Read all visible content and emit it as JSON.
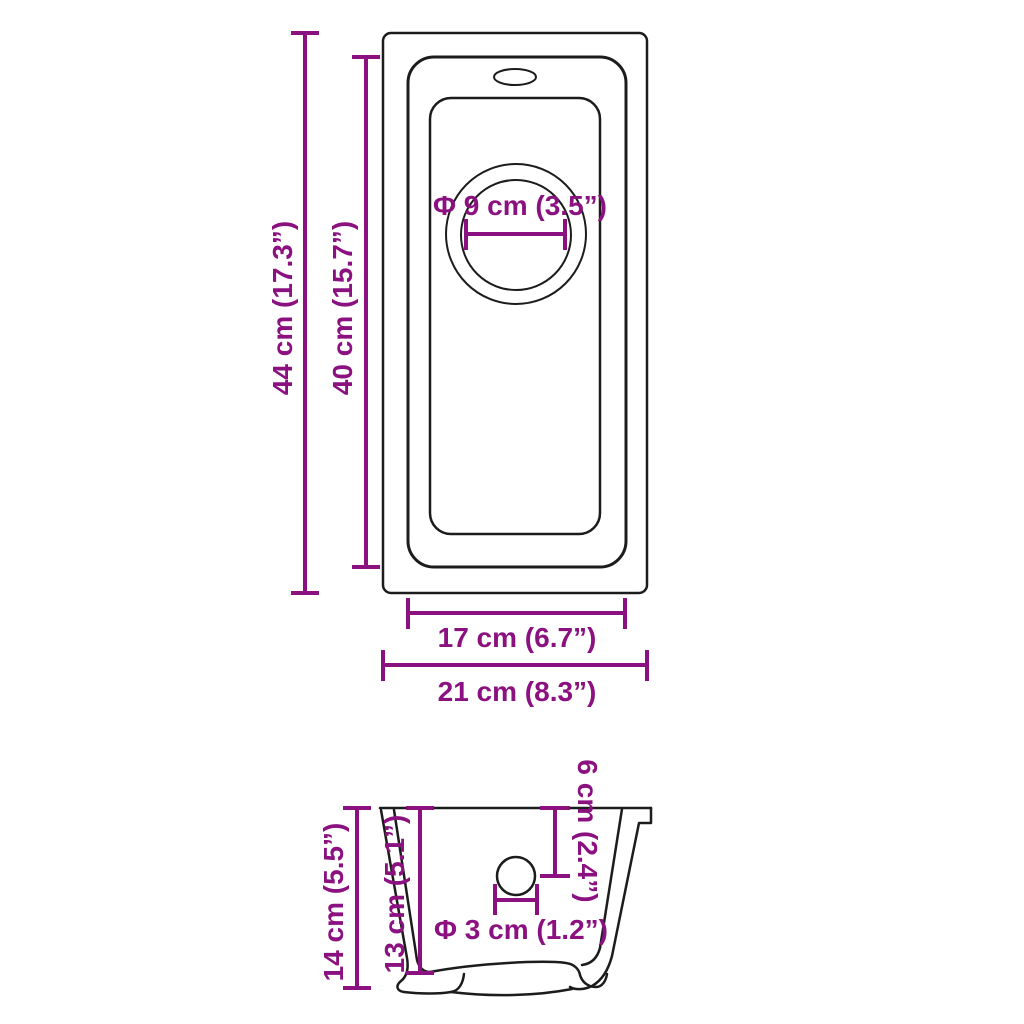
{
  "colors": {
    "dimension": "#8C1180",
    "outline": "#1C1C1C",
    "background": "#FFFFFF"
  },
  "diagram": {
    "description": "Sink dimension drawing, top view and side section view",
    "top_view": {
      "outer_height_label": "44 cm (17.3”)",
      "basin_height_label": "40 cm (15.7”)",
      "drain_diameter_label": "Φ 9 cm (3.5”)",
      "basin_width_label": "17 cm (6.7”)",
      "outer_width_label": "21 cm (8.3”)"
    },
    "side_view": {
      "outer_depth_label": "14 cm (5.5”)",
      "basin_depth_label": "13 cm (5.1”)",
      "drain_offset_label": "6 cm (2.4”)",
      "drain_hole_diameter_label": "Φ 3 cm (1.2”)"
    }
  }
}
